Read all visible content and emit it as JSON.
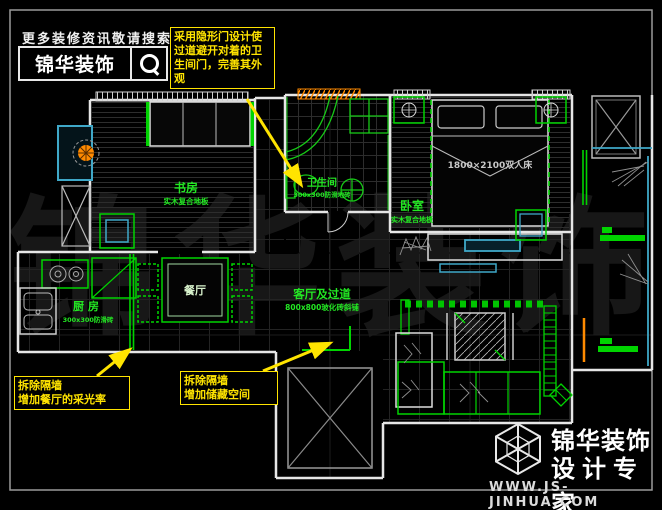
{
  "header": {
    "tagline": "更多装修资讯敬请搜索",
    "brand": "锦华装饰",
    "search_icon": "magnifier-icon"
  },
  "callouts": {
    "hidden_door": {
      "text": "采用隐形门设计使过道避开对着的卫生间门，完善其外观"
    },
    "dining_light": {
      "line1": "拆除隔墙",
      "line2": "增加餐厅的采光率"
    },
    "storage": {
      "line1": "拆除隔墙",
      "line2": "增加储藏空间"
    }
  },
  "rooms": {
    "study": {
      "name": "书房",
      "floor": "实木复合地板"
    },
    "bath": {
      "name": "卫生间",
      "floor": "300x300防滑地砖"
    },
    "bedroom": {
      "name": "卧室",
      "floor": "实木复合地板"
    },
    "kitchen": {
      "name": "厨房",
      "floor": "300x300防滑砖"
    },
    "dining": {
      "name": "餐厅"
    },
    "living": {
      "name": "客厅及过道",
      "floor": "800x800玻化砖斜铺"
    }
  },
  "furniture": {
    "bed_label": "1800×2100双人床"
  },
  "watermark": {
    "text": "锦华装饰"
  },
  "footer": {
    "brand": "锦华装饰",
    "subtitle": "设计专家",
    "website": "WWW.JS-JINHUA.COM"
  },
  "colors": {
    "furniture_green": "#00d400",
    "label_green": "#23e823",
    "window_teal": "#3fa8c8",
    "accent_orange": "#ff8a00",
    "callout_yellow": "#ffe400"
  }
}
